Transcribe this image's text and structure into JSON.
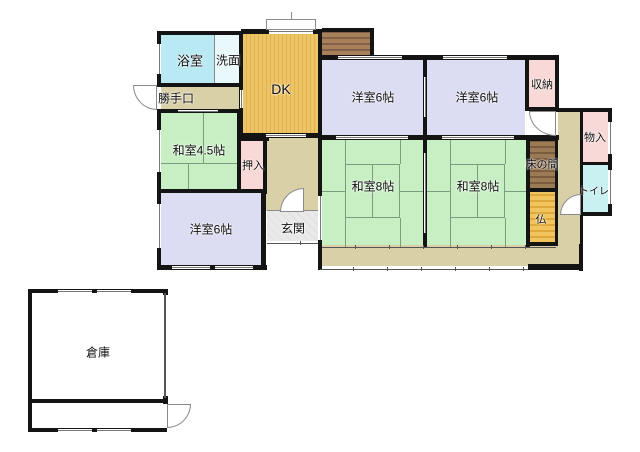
{
  "plan_title": "house-floor-plan",
  "palette": {
    "wall": "#141414",
    "tatami_line": "#7d9b7d",
    "corridor": "#d9d0a8",
    "bath": "#b9e9f2",
    "washroom": "#e8f8fb",
    "dk": "#eec566",
    "dk_stripe": "#e0b14e",
    "deck": "#a8815a",
    "deck_stripe": "#836048",
    "washitsu": "#c8efc4",
    "closet": "#f8d9d7",
    "western_room": "#dcdcf2",
    "toilet": "#c9f1f1",
    "tokonoma": "#9b7a56",
    "tokonoma_stripe": "#7b5b3d",
    "butsu": "#f2c45e",
    "butsu_stripe": "#dda83c",
    "genkan": "#e9e9e9",
    "genkan_stripe": "#dedede",
    "warehouse": "#ffffff"
  },
  "rooms": [
    {
      "n": "room-bathroom",
      "x": 161,
      "y": 35,
      "w": 53,
      "h": 48,
      "bg": "#b9e9f2",
      "pat": "none"
    },
    {
      "n": "room-washroom",
      "x": 215,
      "y": 35,
      "w": 24,
      "h": 48,
      "bg": "#e8f8fb",
      "pat": "none"
    },
    {
      "n": "room-dk",
      "x": 243,
      "y": 34,
      "w": 75,
      "h": 99,
      "bg": "#eec566",
      "pat": "v",
      "stripe": "#e0b14e"
    },
    {
      "n": "wood-deck",
      "x": 322,
      "y": 32,
      "w": 48,
      "h": 23,
      "bg": "#a8815a",
      "pat": "h",
      "stripe": "#836048"
    },
    {
      "n": "corridor-backdoor",
      "x": 161,
      "y": 87,
      "w": 78,
      "h": 22,
      "bg": "#d9d0a8",
      "pat": "none"
    },
    {
      "n": "room-washitsu-4-5",
      "x": 161,
      "y": 113,
      "w": 76,
      "h": 76,
      "bg": "#c8efc4",
      "pat": "none"
    },
    {
      "n": "corridor-center",
      "x": 241,
      "y": 137,
      "w": 77,
      "h": 74,
      "bg": "#d9d0a8",
      "pat": "none"
    },
    {
      "n": "closet-oshiire",
      "x": 241,
      "y": 141,
      "w": 22,
      "h": 48,
      "bg": "#f8d9d7",
      "pat": "none"
    },
    {
      "n": "room-genkan",
      "x": 267,
      "y": 211,
      "w": 51,
      "h": 30,
      "bg": "#e9e9e9",
      "pat": "x",
      "stripe": "#dedede"
    },
    {
      "n": "room-yoshitsu-bl",
      "x": 161,
      "y": 193,
      "w": 100,
      "h": 72,
      "bg": "#dcdcf2",
      "pat": "none"
    },
    {
      "n": "room-yoshitsu-tl",
      "x": 322,
      "y": 60,
      "w": 101,
      "h": 75,
      "bg": "#dcdcf2",
      "pat": "none"
    },
    {
      "n": "room-yoshitsu-tr",
      "x": 427,
      "y": 60,
      "w": 98,
      "h": 75,
      "bg": "#dcdcf2",
      "pat": "none"
    },
    {
      "n": "closet-shuno",
      "x": 529,
      "y": 60,
      "w": 26,
      "h": 47,
      "bg": "#f8d9d7",
      "pat": "none"
    },
    {
      "n": "room-washitsu8-l",
      "x": 322,
      "y": 140,
      "w": 101,
      "h": 105,
      "bg": "#c8efc4",
      "pat": "none"
    },
    {
      "n": "room-washitsu8-r",
      "x": 427,
      "y": 140,
      "w": 99,
      "h": 105,
      "bg": "#c8efc4",
      "pat": "none"
    },
    {
      "n": "alcove-tokonoma",
      "x": 530,
      "y": 141,
      "w": 25,
      "h": 47,
      "bg": "#9b7a56",
      "pat": "h",
      "stripe": "#7b5b3d"
    },
    {
      "n": "alcove-butsudan",
      "x": 530,
      "y": 192,
      "w": 25,
      "h": 50,
      "bg": "#f2c45e",
      "pat": "h",
      "stripe": "#dda83c"
    },
    {
      "n": "corridor-right",
      "x": 558,
      "y": 112,
      "w": 22,
      "h": 133,
      "bg": "#d9d0a8",
      "pat": "none"
    },
    {
      "n": "closet-monoire",
      "x": 583,
      "y": 112,
      "w": 25,
      "h": 50,
      "bg": "#f8d9d7",
      "pat": "none"
    },
    {
      "n": "room-toilet",
      "x": 583,
      "y": 165,
      "w": 25,
      "h": 47,
      "bg": "#c9f1f1",
      "pat": "none"
    },
    {
      "n": "veranda",
      "x": 322,
      "y": 245,
      "w": 257,
      "h": 21,
      "bg": "#d9d0a8",
      "pat": "none"
    },
    {
      "n": "warehouse-main",
      "x": 32,
      "y": 293,
      "w": 132,
      "h": 106,
      "bg": "#ffffff",
      "pat": "none"
    },
    {
      "n": "warehouse-strip",
      "x": 32,
      "y": 403,
      "w": 132,
      "h": 25,
      "bg": "#ffffff",
      "pat": "none"
    }
  ],
  "walls": [
    {
      "x": 157,
      "y": 31,
      "w": 86,
      "h": 4
    },
    {
      "x": 157,
      "y": 31,
      "w": 4,
      "h": 56
    },
    {
      "x": 157,
      "y": 83,
      "w": 86,
      "h": 4
    },
    {
      "x": 157,
      "y": 109,
      "w": 86,
      "h": 4
    },
    {
      "x": 157,
      "y": 112,
      "w": 4,
      "h": 78
    },
    {
      "x": 157,
      "y": 189,
      "w": 108,
      "h": 4
    },
    {
      "x": 157,
      "y": 192,
      "w": 4,
      "h": 76
    },
    {
      "x": 157,
      "y": 265,
      "w": 110,
      "h": 5
    },
    {
      "x": 261,
      "y": 192,
      "w": 5,
      "h": 78
    },
    {
      "x": 239,
      "y": 31,
      "w": 4,
      "h": 106
    },
    {
      "x": 241,
      "y": 29,
      "w": 30,
      "h": 5
    },
    {
      "x": 312,
      "y": 29,
      "w": 10,
      "h": 5
    },
    {
      "x": 241,
      "y": 133,
      "w": 81,
      "h": 5
    },
    {
      "x": 237,
      "y": 112,
      "w": 4,
      "h": 80
    },
    {
      "x": 239,
      "y": 137,
      "w": 30,
      "h": 4
    },
    {
      "x": 263,
      "y": 137,
      "w": 4,
      "h": 57
    },
    {
      "x": 318,
      "y": 29,
      "w": 4,
      "h": 241
    },
    {
      "x": 322,
      "y": 28,
      "w": 52,
      "h": 4
    },
    {
      "x": 370,
      "y": 28,
      "w": 4,
      "h": 32
    },
    {
      "x": 322,
      "y": 55,
      "w": 237,
      "h": 5
    },
    {
      "x": 423,
      "y": 58,
      "w": 4,
      "h": 79
    },
    {
      "x": 318,
      "y": 135,
      "w": 241,
      "h": 5
    },
    {
      "x": 423,
      "y": 140,
      "w": 4,
      "h": 107
    },
    {
      "x": 525,
      "y": 55,
      "w": 4,
      "h": 56
    },
    {
      "x": 525,
      "y": 107,
      "w": 34,
      "h": 4
    },
    {
      "x": 555,
      "y": 55,
      "w": 4,
      "h": 56
    },
    {
      "x": 555,
      "y": 108,
      "w": 57,
      "h": 4
    },
    {
      "x": 608,
      "y": 112,
      "w": 4,
      "h": 104
    },
    {
      "x": 580,
      "y": 112,
      "w": 3,
      "h": 104
    },
    {
      "x": 580,
      "y": 162,
      "w": 31,
      "h": 3
    },
    {
      "x": 580,
      "y": 212,
      "w": 32,
      "h": 4
    },
    {
      "x": 580,
      "y": 216,
      "w": 3,
      "h": 30
    },
    {
      "x": 526,
      "y": 137,
      "w": 4,
      "h": 110
    },
    {
      "x": 526,
      "y": 137,
      "w": 32,
      "h": 4
    },
    {
      "x": 526,
      "y": 188,
      "w": 32,
      "h": 4
    },
    {
      "x": 526,
      "y": 242,
      "w": 32,
      "h": 4
    },
    {
      "x": 555,
      "y": 137,
      "w": 3,
      "h": 107
    },
    {
      "x": 579,
      "y": 244,
      "w": 4,
      "h": 27
    },
    {
      "x": 528,
      "y": 264,
      "w": 54,
      "h": 6
    },
    {
      "x": 28,
      "y": 289,
      "w": 139,
      "h": 4
    },
    {
      "x": 28,
      "y": 289,
      "w": 4,
      "h": 143
    },
    {
      "x": 28,
      "y": 399,
      "w": 139,
      "h": 4
    },
    {
      "x": 28,
      "y": 428,
      "w": 139,
      "h": 4
    },
    {
      "x": 163,
      "y": 289,
      "w": 5,
      "h": 6
    },
    {
      "x": 163,
      "y": 396,
      "w": 5,
      "h": 8
    }
  ],
  "thin_walls": [
    {
      "x": 164,
      "y": 293,
      "w": 2,
      "h": 105
    }
  ],
  "windows": [
    {
      "x": 157,
      "y": 44,
      "w": 4,
      "h": 30
    },
    {
      "x": 269,
      "y": 29,
      "w": 44,
      "h": 5
    },
    {
      "x": 338,
      "y": 56,
      "w": 64,
      "h": 3
    },
    {
      "x": 443,
      "y": 56,
      "w": 64,
      "h": 3
    },
    {
      "x": 157,
      "y": 130,
      "w": 4,
      "h": 42
    },
    {
      "x": 157,
      "y": 204,
      "w": 4,
      "h": 44
    },
    {
      "x": 172,
      "y": 266,
      "w": 38,
      "h": 3
    },
    {
      "x": 215,
      "y": 266,
      "w": 38,
      "h": 3
    },
    {
      "x": 608,
      "y": 122,
      "w": 4,
      "h": 32
    },
    {
      "x": 608,
      "y": 170,
      "w": 4,
      "h": 34
    },
    {
      "x": 58,
      "y": 290,
      "w": 34,
      "h": 3
    },
    {
      "x": 97,
      "y": 290,
      "w": 34,
      "h": 3
    },
    {
      "x": 58,
      "y": 429,
      "w": 34,
      "h": 3
    },
    {
      "x": 97,
      "y": 429,
      "w": 34,
      "h": 3
    },
    {
      "x": 240,
      "y": 90,
      "w": 3,
      "h": 18
    },
    {
      "x": 266,
      "y": 134,
      "w": 40,
      "h": 3
    },
    {
      "x": 178,
      "y": 110,
      "w": 40,
      "h": 2
    },
    {
      "x": 424,
      "y": 77,
      "w": 2,
      "h": 40
    },
    {
      "x": 424,
      "y": 153,
      "w": 2,
      "h": 80
    },
    {
      "x": 336,
      "y": 136,
      "w": 72,
      "h": 3
    },
    {
      "x": 442,
      "y": 136,
      "w": 72,
      "h": 3
    },
    {
      "x": 318,
      "y": 196,
      "w": 4,
      "h": 44
    }
  ],
  "sliding_lines": [
    {
      "x": 322,
      "y": 245,
      "w": 234,
      "h": 4
    },
    {
      "x": 320,
      "y": 267,
      "w": 208,
      "h": 4
    },
    {
      "x": 267,
      "y": 241,
      "w": 51,
      "h": 4
    }
  ],
  "tatami_rects": [
    {
      "x": 345,
      "y": 164,
      "w": 55,
      "h": 54
    },
    {
      "x": 450,
      "y": 164,
      "w": 55,
      "h": 54
    }
  ],
  "tatami_lines": [
    {
      "x": 372,
      "y": 164,
      "w": 1,
      "h": 54
    },
    {
      "x": 345,
      "y": 140,
      "w": 1,
      "h": 24
    },
    {
      "x": 400,
      "y": 140,
      "w": 1,
      "h": 24
    },
    {
      "x": 345,
      "y": 218,
      "w": 1,
      "h": 29
    },
    {
      "x": 400,
      "y": 218,
      "w": 1,
      "h": 29
    },
    {
      "x": 322,
      "y": 191,
      "w": 23,
      "h": 1
    },
    {
      "x": 400,
      "y": 191,
      "w": 25,
      "h": 1
    },
    {
      "x": 477,
      "y": 164,
      "w": 1,
      "h": 54
    },
    {
      "x": 450,
      "y": 140,
      "w": 1,
      "h": 24
    },
    {
      "x": 505,
      "y": 140,
      "w": 1,
      "h": 24
    },
    {
      "x": 450,
      "y": 218,
      "w": 1,
      "h": 29
    },
    {
      "x": 505,
      "y": 218,
      "w": 1,
      "h": 29
    },
    {
      "x": 427,
      "y": 191,
      "w": 23,
      "h": 1
    },
    {
      "x": 505,
      "y": 191,
      "w": 25,
      "h": 1
    },
    {
      "x": 161,
      "y": 163,
      "w": 80,
      "h": 1
    },
    {
      "x": 203,
      "y": 113,
      "w": 1,
      "h": 50
    },
    {
      "x": 188,
      "y": 163,
      "w": 1,
      "h": 26
    }
  ],
  "gray_lines": [
    {
      "x": 214,
      "y": 35,
      "w": 1,
      "h": 48
    },
    {
      "x": 267,
      "y": 210,
      "w": 51,
      "h": 1
    },
    {
      "x": 291,
      "y": 12,
      "w": 1,
      "h": 7
    }
  ],
  "doors": [
    {
      "n": "door-backdoor",
      "x": 133,
      "y": 85,
      "w": 24,
      "h": 25,
      "pivot": "tr"
    },
    {
      "n": "door-genkan",
      "x": 280,
      "y": 188,
      "w": 24,
      "h": 24,
      "pivot": "br"
    },
    {
      "n": "door-hall-to-room",
      "x": 529,
      "y": 111,
      "w": 27,
      "h": 25,
      "pivot": "tr"
    },
    {
      "n": "door-toilet",
      "x": 560,
      "y": 194,
      "w": 21,
      "h": 21,
      "pivot": "br"
    },
    {
      "n": "door-warehouse",
      "x": 167,
      "y": 404,
      "w": 24,
      "h": 24,
      "pivot": "tl"
    }
  ],
  "bay_window": {
    "x": 266,
    "y": 19,
    "w": 50,
    "h": 11
  },
  "labels": [
    {
      "id": "bathroom",
      "text": "浴室",
      "x": 190,
      "y": 60,
      "size": 13
    },
    {
      "id": "washroom",
      "text": "洗面",
      "x": 228,
      "y": 60,
      "size": 12
    },
    {
      "id": "dk",
      "text": "DK",
      "x": 281,
      "y": 89,
      "size": 14
    },
    {
      "id": "backdoor",
      "text": "勝手口",
      "x": 176,
      "y": 98,
      "size": 12
    },
    {
      "id": "washitsu45",
      "text": "和室4.5帖",
      "x": 199,
      "y": 150,
      "size": 12
    },
    {
      "id": "oshiire",
      "text": "押入",
      "x": 253,
      "y": 165,
      "size": 11
    },
    {
      "id": "yoshitsu-bl",
      "text": "洋室6帖",
      "x": 211,
      "y": 229,
      "size": 12
    },
    {
      "id": "genkan",
      "text": "玄関",
      "x": 293,
      "y": 228,
      "size": 12
    },
    {
      "id": "yoshitsu-tl",
      "text": "洋室6帖",
      "x": 373,
      "y": 97,
      "size": 12
    },
    {
      "id": "yoshitsu-tr",
      "text": "洋室6帖",
      "x": 477,
      "y": 97,
      "size": 12
    },
    {
      "id": "shuno",
      "text": "収納",
      "x": 542,
      "y": 84,
      "size": 11
    },
    {
      "id": "monoire",
      "text": "物入",
      "x": 595,
      "y": 137,
      "size": 11
    },
    {
      "id": "toilet",
      "text": "トイレ",
      "x": 594,
      "y": 190,
      "size": 10
    },
    {
      "id": "tokonoma",
      "text": "床の間",
      "x": 542,
      "y": 164,
      "size": 11
    },
    {
      "id": "butsudan",
      "text": "仏",
      "x": 541,
      "y": 219,
      "size": 11
    },
    {
      "id": "washitsu8-l",
      "text": "和室8帖",
      "x": 373,
      "y": 186,
      "size": 12
    },
    {
      "id": "washitsu8-r",
      "text": "和室8帖",
      "x": 478,
      "y": 186,
      "size": 12
    },
    {
      "id": "warehouse",
      "text": "倉庫",
      "x": 98,
      "y": 352,
      "size": 12
    }
  ]
}
